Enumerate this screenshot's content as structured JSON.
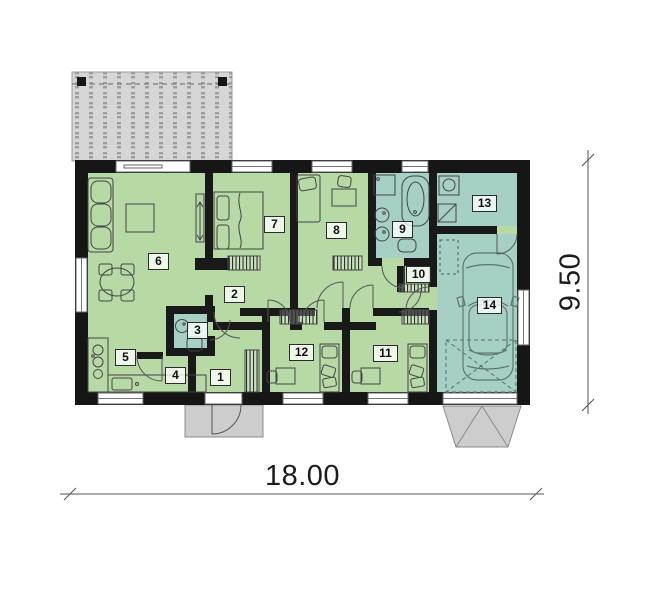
{
  "plan": {
    "rooms": [
      {
        "number": "1"
      },
      {
        "number": "2"
      },
      {
        "number": "3"
      },
      {
        "number": "4"
      },
      {
        "number": "5"
      },
      {
        "number": "6"
      },
      {
        "number": "7"
      },
      {
        "number": "8"
      },
      {
        "number": "9"
      },
      {
        "number": "10"
      },
      {
        "number": "11"
      },
      {
        "number": "12"
      },
      {
        "number": "13"
      },
      {
        "number": "14"
      }
    ],
    "dimensions": {
      "width_label": "18.00",
      "height_label": "9.50"
    },
    "colors": {
      "wall": "#1a1a1a",
      "room_green": "#b6d9a5",
      "room_teal": "#a6d0c5",
      "terrace_gray": "#d6d6d6",
      "porch_gray": "#cdcdcd"
    }
  }
}
